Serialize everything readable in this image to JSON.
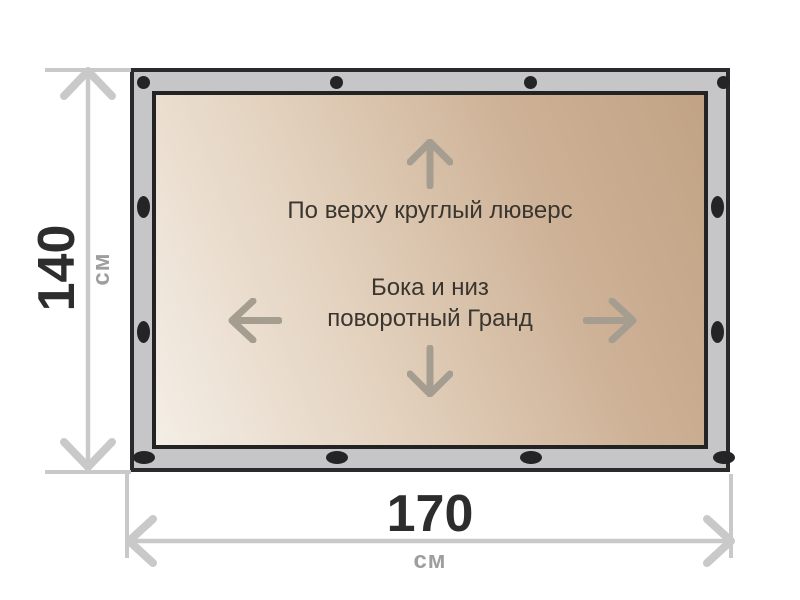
{
  "fabric": {
    "top_note": "По верху круглый люверс",
    "center_note_line1": "Бока и низ",
    "center_note_line2": "поворотный Гранд"
  },
  "dimensions": {
    "height": {
      "value": "140",
      "unit": "см"
    },
    "width": {
      "value": "170",
      "unit": "см"
    }
  },
  "grommets": {
    "top": 4,
    "bottom": 4,
    "left": 2,
    "right": 2,
    "total": 12
  },
  "icons": {
    "arrow_up": "arrow-up-icon",
    "arrow_down": "arrow-down-icon",
    "arrow_left": "arrow-left-icon",
    "arrow_right": "arrow-right-icon",
    "grommet": "grommet-icon",
    "height_dimension": "height-dimension-arrow-icon",
    "width_dimension": "width-dimension-arrow-icon"
  },
  "colors": {
    "background": "#ffffff",
    "frame_fill": "#c6c6c9",
    "frame_border": "#2a2a2c",
    "fabric_gradient_light": "#f4eee6",
    "fabric_gradient_dark": "#c1a284",
    "grommet": "#242427",
    "fabric_arrow": "#a69d91",
    "note_text": "#3a362f",
    "dimension_line": "#c9c9c9",
    "dimension_value_text": "#2d2d2d",
    "dimension_unit_text": "#9e9e9e"
  }
}
